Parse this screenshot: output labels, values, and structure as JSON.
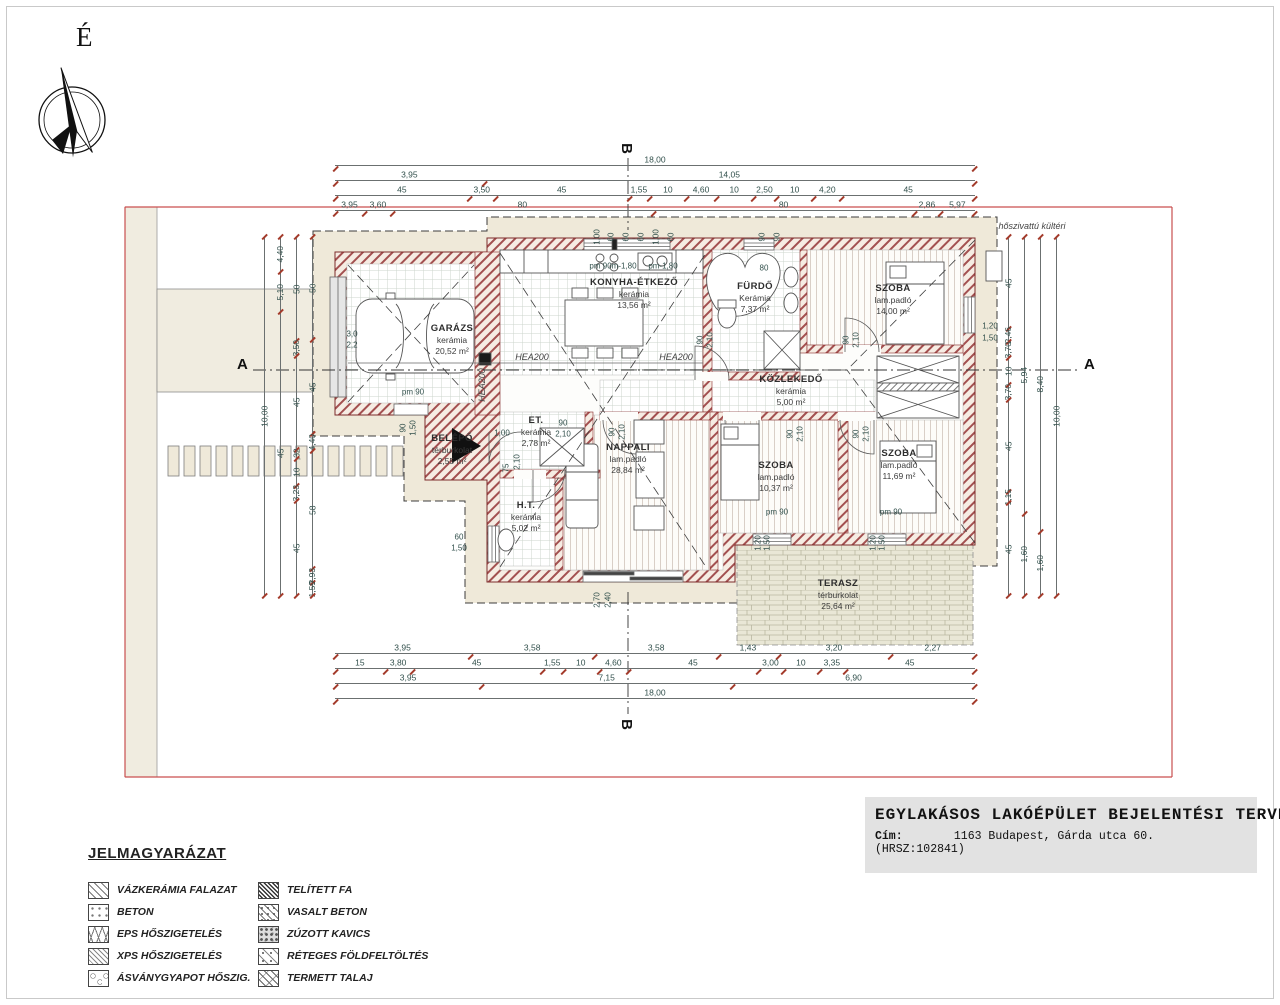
{
  "compass": {
    "label": "É"
  },
  "sections": {
    "a": "A",
    "b": "B"
  },
  "plan": {
    "rooms": [
      {
        "name": "GARÁZS",
        "finish": "kerámia",
        "area": "20,52 m²",
        "x": 452,
        "y": 340
      },
      {
        "name": "KONYHA-ÉTKEZŐ",
        "finish": "kerámia",
        "area": "13,56 m²",
        "x": 634,
        "y": 294
      },
      {
        "name": "FÜRDŐ",
        "finish": "Kerámia",
        "area": "7,37 m²",
        "x": 755,
        "y": 298
      },
      {
        "name": "SZOBA",
        "finish": "lam.padló",
        "area": "14,00 m²",
        "x": 893,
        "y": 300
      },
      {
        "name": "KÖZLEKEDŐ",
        "finish": "kerámia",
        "area": "5,00 m²",
        "x": 791,
        "y": 391
      },
      {
        "name": "SZOBA",
        "finish": "lam.padló",
        "area": "10,37 m²",
        "x": 776,
        "y": 477
      },
      {
        "name": "SZOBA",
        "finish": "lam.padló",
        "area": "11,69 m²",
        "x": 899,
        "y": 465
      },
      {
        "name": "NAPPALI",
        "finish": "lam.padló",
        "area": "28,84 m²",
        "x": 628,
        "y": 459
      },
      {
        "name": "H.T.",
        "finish": "kerámia",
        "area": "5,02 m²",
        "x": 526,
        "y": 517
      },
      {
        "name": "ET.",
        "finish": "kerámia",
        "area": "2,78 m²",
        "x": 536,
        "y": 432
      },
      {
        "name": "BELÉPŐ",
        "finish": "térburkolat",
        "area": "2,55 m²",
        "x": 452,
        "y": 450
      },
      {
        "name": "TERASZ",
        "finish": "térburkolat",
        "area": "25,64 m²",
        "x": 838,
        "y": 595
      }
    ],
    "annotations": [
      {
        "t": "hőszivattú kültéri",
        "x": 1032,
        "y": 226,
        "i": 1
      },
      {
        "t": "HEA200",
        "x": 532,
        "y": 357,
        "i": 1
      },
      {
        "t": "HEA200",
        "x": 676,
        "y": 357,
        "i": 1
      },
      {
        "t": "HEA200",
        "x": 482,
        "y": 385,
        "r": 1,
        "i": 1
      },
      {
        "t": "pm 90",
        "x": 413,
        "y": 392
      },
      {
        "t": "pm 90",
        "x": 777,
        "y": 512
      },
      {
        "t": "pm 90",
        "x": 891,
        "y": 512
      },
      {
        "t": "pm 90m-1,80",
        "x": 613,
        "y": 266
      },
      {
        "t": "pm-1,80",
        "x": 663,
        "y": 266
      },
      {
        "t": "80",
        "x": 764,
        "y": 268
      },
      {
        "t": "90",
        "x": 700,
        "y": 340,
        "r": 1
      },
      {
        "t": "2,10",
        "x": 710,
        "y": 340,
        "r": 1
      },
      {
        "t": "90",
        "x": 846,
        "y": 340,
        "r": 1
      },
      {
        "t": "2,10",
        "x": 856,
        "y": 340,
        "r": 1
      },
      {
        "t": "90",
        "x": 790,
        "y": 434,
        "r": 1
      },
      {
        "t": "2,10",
        "x": 800,
        "y": 434,
        "r": 1
      },
      {
        "t": "90",
        "x": 856,
        "y": 434,
        "r": 1
      },
      {
        "t": "2,10",
        "x": 866,
        "y": 434,
        "r": 1
      },
      {
        "t": "90",
        "x": 612,
        "y": 432,
        "r": 1
      },
      {
        "t": "2,10",
        "x": 622,
        "y": 432,
        "r": 1
      },
      {
        "t": "90",
        "x": 563,
        "y": 423
      },
      {
        "t": "2,10",
        "x": 563,
        "y": 434
      },
      {
        "t": "1,00",
        "x": 502,
        "y": 433
      },
      {
        "t": "75",
        "x": 506,
        "y": 468,
        "r": 1
      },
      {
        "t": "2,10",
        "x": 517,
        "y": 462,
        "r": 1
      },
      {
        "t": "60",
        "x": 459,
        "y": 537
      },
      {
        "t": "1,50",
        "x": 459,
        "y": 548
      },
      {
        "t": "90",
        "x": 403,
        "y": 428,
        "r": 1
      },
      {
        "t": "1,50",
        "x": 413,
        "y": 428,
        "r": 1
      },
      {
        "t": "3,0",
        "x": 352,
        "y": 334
      },
      {
        "t": "2,2",
        "x": 352,
        "y": 345
      },
      {
        "t": "2,70",
        "x": 597,
        "y": 600,
        "r": 1
      },
      {
        "t": "2,40",
        "x": 608,
        "y": 600,
        "r": 1
      },
      {
        "t": "1,20",
        "x": 990,
        "y": 326
      },
      {
        "t": "1,50",
        "x": 990,
        "y": 338
      },
      {
        "t": "1,20",
        "x": 758,
        "y": 543,
        "r": 1
      },
      {
        "t": "1,50",
        "x": 767,
        "y": 543,
        "r": 1
      },
      {
        "t": "1,20",
        "x": 873,
        "y": 543,
        "r": 1
      },
      {
        "t": "1,50",
        "x": 882,
        "y": 543,
        "r": 1
      },
      {
        "t": "1,00",
        "x": 597,
        "y": 237,
        "r": 1
      },
      {
        "t": "60",
        "x": 611,
        "y": 237,
        "r": 1
      },
      {
        "t": "60",
        "x": 626,
        "y": 237,
        "r": 1
      },
      {
        "t": "60",
        "x": 641,
        "y": 237,
        "r": 1
      },
      {
        "t": "1,00",
        "x": 656,
        "y": 237,
        "r": 1
      },
      {
        "t": "60",
        "x": 671,
        "y": 237,
        "r": 1
      },
      {
        "t": "90",
        "x": 762,
        "y": 237,
        "r": 1
      },
      {
        "t": "90",
        "x": 777,
        "y": 237,
        "r": 1
      }
    ]
  },
  "dims": {
    "top": [
      [
        "18,00"
      ],
      [
        "3,95",
        "14,05"
      ],
      [
        "45",
        "3,50",
        "45",
        "1,55",
        "10",
        "4,60",
        "10",
        "2,50",
        "10",
        "4,20",
        "45"
      ],
      [
        "3,95",
        "3,60",
        "80",
        "80",
        "2,86",
        "5,97"
      ]
    ],
    "bottom": [
      [
        "3,95",
        "3,58",
        "3,58",
        "1,43",
        "3,20",
        "2,27"
      ],
      [
        "15",
        "3,80",
        "45",
        "1,55",
        "10",
        "4,60",
        "45",
        "3,00",
        "10",
        "3,35",
        "45"
      ],
      [
        "3,95",
        "7,15",
        "6,90"
      ],
      [
        "18,00"
      ]
    ],
    "left": [
      [
        "10,00"
      ],
      [
        "4,40",
        "5,10",
        "45"
      ],
      [
        "50",
        "3,50",
        "45",
        ",32",
        "10",
        "3,23",
        "45"
      ],
      [
        "50",
        "45",
        "4,40",
        "58",
        "2,93",
        "1,59"
      ]
    ],
    "right": [
      [
        "45",
        "2,46",
        "3,70",
        "10",
        "3,70",
        "45",
        "1,15",
        "45"
      ],
      [
        "5,94",
        "1,60"
      ],
      [
        "8,40",
        "1,60"
      ],
      [
        "10,00"
      ]
    ]
  },
  "title_block": {
    "title": "EGYLAKÁSOS LAKÓÉPÜLET BEJELENTÉSI TERVE",
    "address_label": "Cím:",
    "address": "1163 Budapest, Gárda utca 60. (HRSZ:102841)"
  },
  "legend": {
    "heading": "JELMAGYARÁZAT",
    "items": [
      {
        "label": "VÁZKERÁMIA FALAZAT"
      },
      {
        "label": "BETON"
      },
      {
        "label": "EPS HŐSZIGETELÉS"
      },
      {
        "label": "XPS HŐSZIGETELÉS"
      },
      {
        "label": "ÁSVÁNYGYAPOT HŐSZIG."
      },
      {
        "label": "TELÍTETT FA"
      },
      {
        "label": "VASALT BETON"
      },
      {
        "label": "ZÚZOTT KAVICS"
      },
      {
        "label": "RÉTEGES FÖLDFELTÖLTÉS"
      },
      {
        "label": "TERMETT TALAJ"
      }
    ]
  }
}
